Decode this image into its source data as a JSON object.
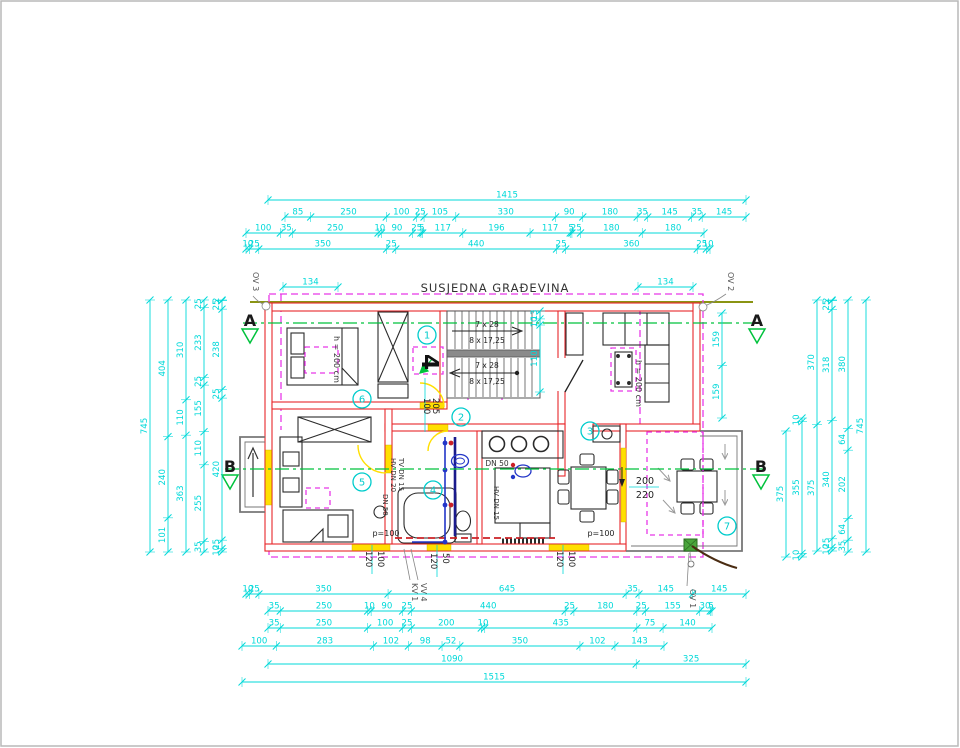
{
  "title": "SUSJEDNA GRAĐEVINA",
  "section_labels": {
    "a_left": "A",
    "a_right": "A",
    "b_left": "B",
    "b_right": "B"
  },
  "openings": {
    "ov1": "OV 1",
    "ov2": "OV 2",
    "ov3": "OV 3",
    "kv1": "KV 1",
    "vv4": "VV 4"
  },
  "room_numbers": {
    "n1": "1",
    "n2": "2",
    "n3": "3",
    "n4": "4",
    "n5": "5",
    "n6": "6",
    "n7": "7"
  },
  "detail_marker": "4",
  "room_texts": {
    "height_left": "h = 200 cm",
    "height_right": "h = 200 cm",
    "stair_up_run": "7 x 28",
    "stair_up_rise": "8 x 17,25",
    "stair_down_run": "7 x 28",
    "stair_down_rise": "8 x 17,25",
    "parapet_left": "p=100",
    "parapet_right": "p=100"
  },
  "pipe_labels": {
    "dn50_kitchen": "DN 50",
    "hv_dn15": "HV DN 15",
    "tv_dn15": "TV DN 15",
    "hv_dn20": "HV DN 20",
    "dn50_bath": "DN 50"
  },
  "opening_dims": {
    "door_width": "100",
    "door_height": "205",
    "window_right_width": "200",
    "window_right_height": "220",
    "w1_h": "120",
    "w1_w": "100",
    "w2_h": "120",
    "w2_w": "50",
    "w3_h": "120",
    "w3_w": "100"
  },
  "colors": {
    "dimension": "#00d9d9",
    "wall": "#e8262a",
    "projection": "#e838e8",
    "section": "#00c23c",
    "boundary": "#8a9413",
    "opening": "#ffdf00",
    "water_cold": "#2336c8",
    "water_hot": "#cb2026",
    "drain": "#4aa53c"
  },
  "dimensions": {
    "horizontal": [
      {
        "name": "top-total",
        "y": 200,
        "x0": 268,
        "x1": 746,
        "values": [
          "1415"
        ]
      },
      {
        "name": "top-row-2",
        "y": 217,
        "x0": 285,
        "x1": 746,
        "values": [
          "85",
          "250",
          "100",
          "25",
          "105",
          "330",
          "90",
          "180",
          "35",
          "145",
          "35",
          "145"
        ]
      },
      {
        "name": "top-row-3",
        "y": 233,
        "x0": 246,
        "x1": 704,
        "values": [
          "100",
          "35",
          "250",
          "10",
          "90",
          "25",
          "5",
          "117",
          "196",
          "117",
          "5",
          "25",
          "180",
          "180"
        ]
      },
      {
        "name": "top-row-4",
        "y": 249,
        "x0": 246,
        "x1": 710,
        "values": [
          "10",
          "25",
          "350",
          "25",
          "440",
          "25",
          "360",
          "25",
          "10"
        ]
      },
      {
        "name": "top-134-left",
        "y": 287,
        "x0": 283,
        "x1": 338,
        "values": [
          "134"
        ]
      },
      {
        "name": "top-134-right",
        "y": 287,
        "x0": 638,
        "x1": 693,
        "values": [
          "134"
        ]
      },
      {
        "name": "bottom-row-1",
        "y": 594,
        "x0": 246,
        "x1": 746,
        "values": [
          "10",
          "25",
          "350",
          "645",
          "35",
          "145",
          "145"
        ]
      },
      {
        "name": "bottom-row-2",
        "y": 611,
        "x0": 268,
        "x1": 712,
        "values": [
          "35",
          "250",
          "10",
          "90",
          "25",
          "440",
          "25",
          "180",
          "25",
          "155",
          "30",
          "5"
        ]
      },
      {
        "name": "bottom-row-3",
        "y": 628,
        "x0": 268,
        "x1": 712,
        "values": [
          "35",
          "250",
          "100",
          "25",
          "200",
          "10",
          "435",
          "75",
          "140"
        ]
      },
      {
        "name": "bottom-row-4",
        "y": 646,
        "x0": 242,
        "x1": 664,
        "values": [
          "100",
          "283",
          "102",
          "98",
          "52",
          "350",
          "102",
          "143"
        ]
      },
      {
        "name": "bottom-row-5",
        "y": 664,
        "x0": 268,
        "x1": 746,
        "values": [
          "1090",
          "325"
        ]
      },
      {
        "name": "bottom-row-6",
        "y": 682,
        "x0": 242,
        "x1": 746,
        "values": [
          "1515"
        ]
      }
    ],
    "vertical": [
      {
        "name": "left-1",
        "x": 150,
        "y0": 300,
        "y1": 552,
        "values": [
          "745"
        ]
      },
      {
        "name": "left-2",
        "x": 168,
        "y0": 300,
        "y1": 552,
        "values": [
          "404",
          "240",
          "101"
        ]
      },
      {
        "name": "left-3",
        "x": 186,
        "y0": 300,
        "y1": 552,
        "values": [
          "310",
          "110",
          "363"
        ]
      },
      {
        "name": "left-4",
        "x": 204,
        "y0": 300,
        "y1": 552,
        "values": [
          "25",
          "233",
          "25",
          "155",
          "110",
          "255",
          "35"
        ]
      },
      {
        "name": "left-5",
        "x": 222,
        "y0": 300,
        "y1": 552,
        "values": [
          "2",
          "25",
          "238",
          "25",
          "420",
          "25",
          "10"
        ]
      },
      {
        "name": "right-window",
        "x": 722,
        "y0": 313,
        "y1": 418,
        "values": [
          "159",
          "159"
        ]
      },
      {
        "name": "right-1",
        "x": 786,
        "y0": 431,
        "y1": 557,
        "values": [
          "375"
        ]
      },
      {
        "name": "right-2",
        "x": 802,
        "y0": 418,
        "y1": 557,
        "values": [
          "10",
          "355",
          "10"
        ]
      },
      {
        "name": "right-3",
        "x": 817,
        "y0": 300,
        "y1": 551,
        "values": [
          "370",
          "375"
        ]
      },
      {
        "name": "right-4",
        "x": 832,
        "y0": 300,
        "y1": 551,
        "values": [
          "2",
          "25",
          "318",
          "340",
          "25",
          "10"
        ]
      },
      {
        "name": "right-5",
        "x": 848,
        "y0": 300,
        "y1": 552,
        "values": [
          "380",
          "64",
          "202",
          "64",
          "35"
        ]
      },
      {
        "name": "right-6",
        "x": 866,
        "y0": 300,
        "y1": 552,
        "values": [
          "745"
        ]
      },
      {
        "name": "stair-width",
        "x": 540,
        "y0": 311,
        "y1": 392,
        "values": [
          "13",
          "10",
          "110"
        ]
      }
    ]
  }
}
